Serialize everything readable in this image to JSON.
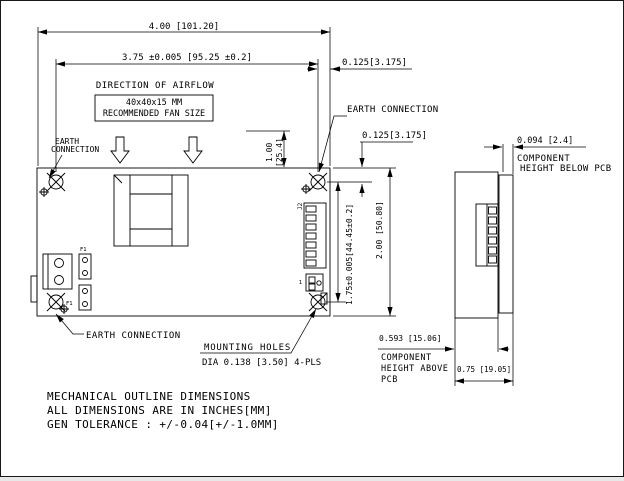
{
  "colors": {
    "ink": "#000000",
    "bg": "#ffffff"
  },
  "top_view": {
    "dim_overall_width": "4.00 [101.20]",
    "dim_hole_spacing_h": "3.75 ±0.005 [95.25 ±0.2]",
    "dim_hole_edge_offset_h": "0.125[3.175]",
    "dim_hole_edge_offset_v": "0.125[3.175]",
    "dim_fan_clearance_in": "1.00",
    "dim_fan_clearance_mm": "[25.4]",
    "airflow_label": "DIRECTION OF AIRFLOW",
    "fan_box": {
      "line1": "40x40x15 MM",
      "line2": "RECOMMENDED FAN SIZE"
    },
    "earth_top": "EARTH CONNECTION",
    "earth_left_l1": "EARTH",
    "earth_left_l2": "CONNECTION",
    "earth_bottom": "EARTH CONNECTION",
    "dim_hole_spacing_v": "1.75±0.005[44.45±0.2]",
    "dim_overall_height": "2.00 [50.80]",
    "mounting_label": "MOUNTING HOLES",
    "mounting_spec": "DIA 0.138 [3.50] 4-PLS",
    "ref_f1_top": "F1",
    "ref_f1_bottom": "F1",
    "ref_j2": "J2",
    "ref_pin1": "1"
  },
  "side_view": {
    "dim_below_pcb": "0.094 [2.4]",
    "below_label_l1": "COMPONENT",
    "below_label_l2": "HEIGHT BELOW PCB",
    "dim_above_pcb": "0.593 [15.06]",
    "above_label_l1": "COMPONENT",
    "above_label_l2": "HEIGHT ABOVE",
    "above_label_l3": "PCB",
    "dim_overall_depth": "0.75 [19.05]"
  },
  "notes": {
    "line1": "MECHANICAL OUTLINE DIMENSIONS",
    "line2": "ALL DIMENSIONS ARE IN INCHES[MM]",
    "line3": "GEN TOLERANCE : +/-0.04[+/-1.0MM]"
  }
}
